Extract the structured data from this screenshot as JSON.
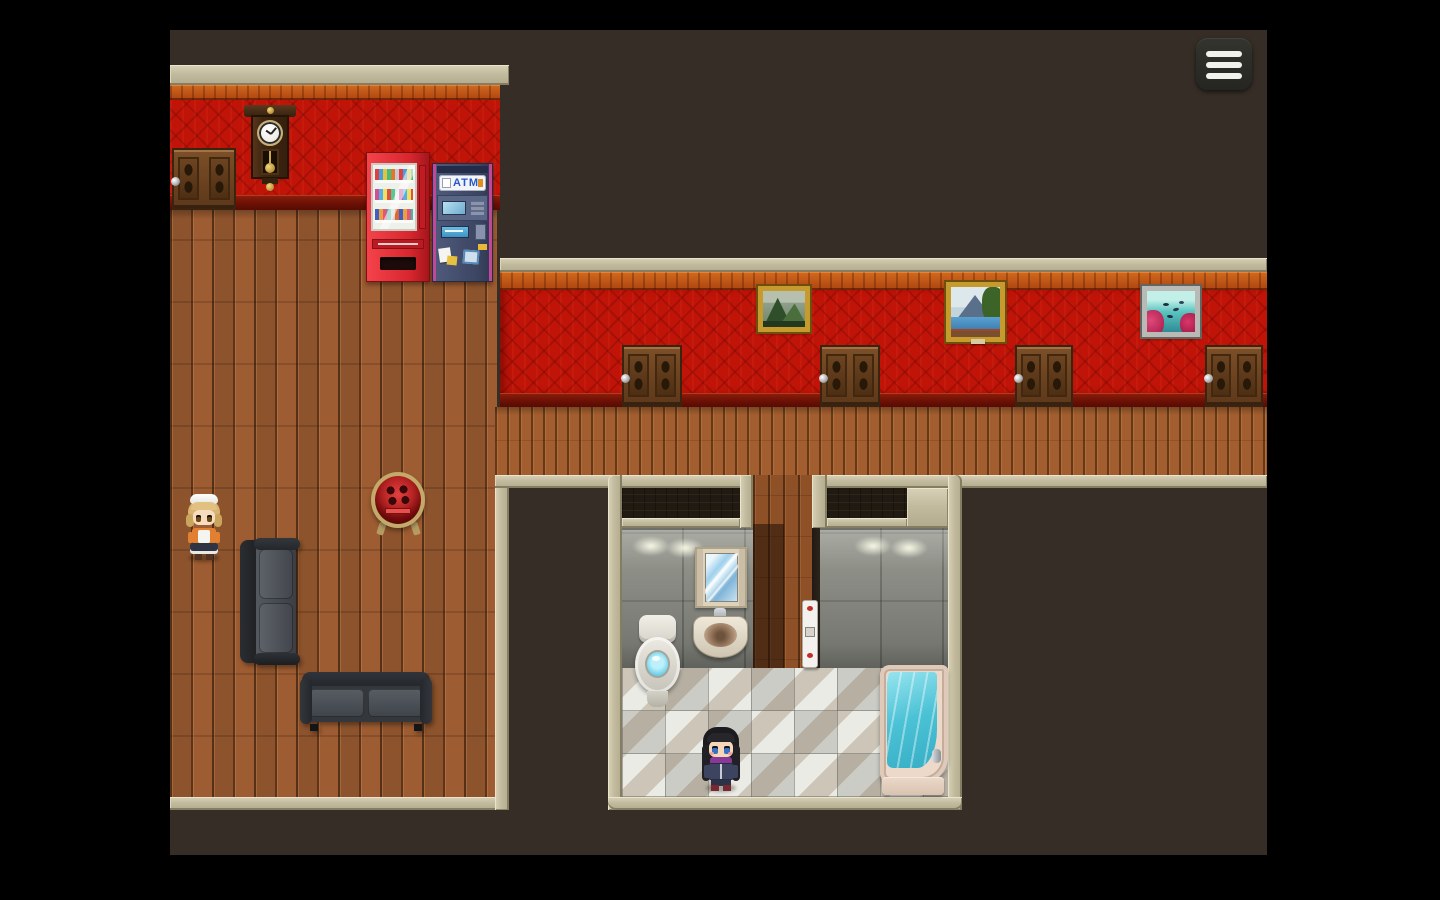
{
  "labels": {
    "atm_sign": "ATM"
  },
  "hud": {
    "menu_button": {
      "icon": "hamburger-menu-icon",
      "bar_count": 3
    }
  },
  "scene": {
    "style": "top-down pixel RPG interior (hotel)",
    "rooms": [
      {
        "name": "lobby",
        "objects": [
          "door-west",
          "wall-clock",
          "vending-machine",
          "atm-machine",
          "maid-npc",
          "round-heater",
          "sofa-vertical",
          "sofa-horizontal"
        ]
      },
      {
        "name": "corridor",
        "doors": [
          "corridor-door-1",
          "corridor-door-2",
          "corridor-door-3",
          "corridor-door-4"
        ],
        "paintings": [
          {
            "name": "mountain-painting",
            "frame": "gold",
            "subject": "green mountains"
          },
          {
            "name": "lake-painting",
            "frame": "gold",
            "subject": "mountain lake with tree"
          },
          {
            "name": "aquarium-painting",
            "frame": "silver",
            "subject": "fish and red coral underwater"
          }
        ]
      },
      {
        "name": "bathroom",
        "fixtures": [
          "mirror-cabinet",
          "sink",
          "toilet",
          "shower-panel",
          "bathtub"
        ],
        "characters": [
          "player-character"
        ]
      }
    ]
  },
  "palette": {
    "letterbox": "#000000",
    "brick": "#39312a",
    "wallpaper_red": "#c01408",
    "accent_orange": "#c8571e",
    "trim_beige": "#c3bb9e",
    "wood_floor": "#9d5c31",
    "bathroom_wall": "#8d8f87",
    "tile_light": "#ebebe5",
    "bathtub_water": "#58c8d8",
    "toilet_water": "#7adef0",
    "vending_red": "#e0303a",
    "atm_body": "#46506e",
    "menu_button_bg": "#2a2a26",
    "menu_bar": "#f2f2ec",
    "atm_text": "#2858c8"
  }
}
